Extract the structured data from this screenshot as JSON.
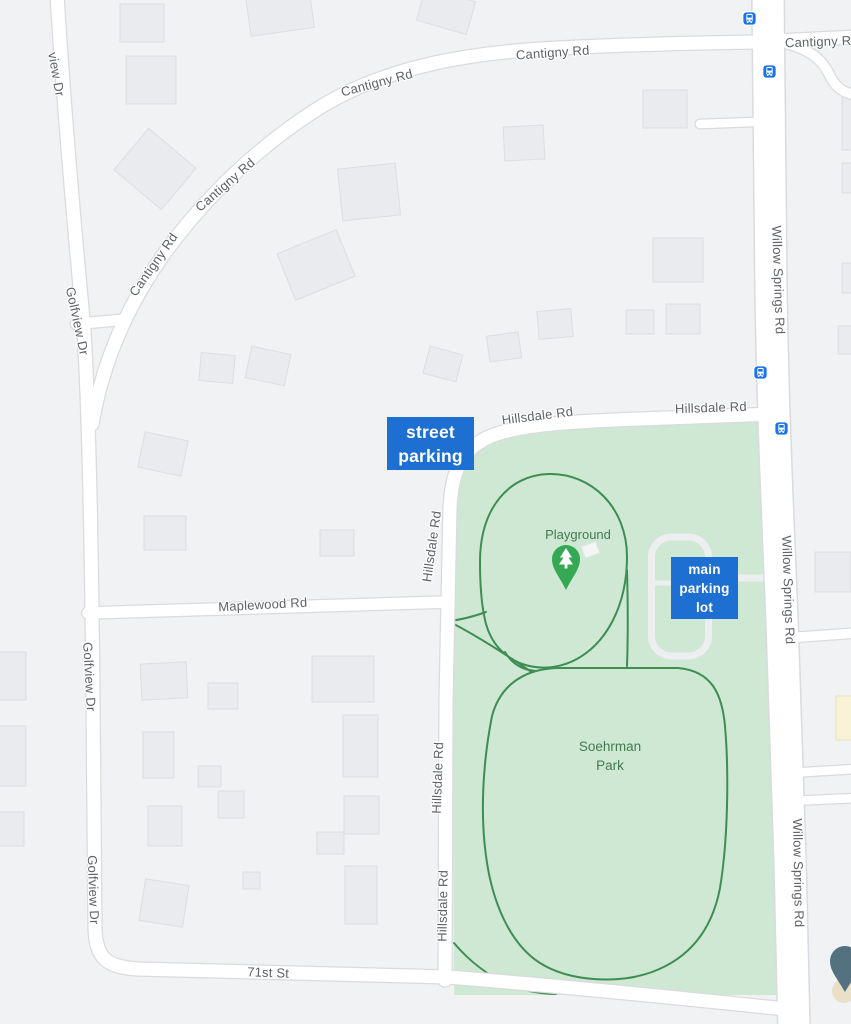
{
  "park": {
    "name": "Soehrman\nPark",
    "playground_label": "Playground",
    "fill_color": "#cee8d3",
    "path_color": "#3e8e53",
    "label_color": "#447b51"
  },
  "roads": {
    "label_color": "#5e6167",
    "cantigny_rd": "Cantigny Rd",
    "golfview_dr": "Golfview Dr",
    "golfview_dr_partial": "view Dr",
    "hillsdale_rd": "Hillsdale Rd",
    "maplewood_rd": "Maplewood Rd",
    "seventy_first_st": "71st St",
    "willow_springs_rd": "Willow Springs Rd"
  },
  "annotations": {
    "street_parking": {
      "label": "street\nparking",
      "bg_color": "#1d6fd1",
      "text_color": "#ffffff"
    },
    "main_parking_lot": {
      "label": "main\nparking\nlot",
      "bg_color": "#1d6fd1",
      "text_color": "#ffffff"
    }
  },
  "transit": {
    "bus_stop_count": 4,
    "bus_icon_color": "#1a73e8"
  },
  "markers": {
    "playground_pin_color": "#34a853",
    "place_pin_color": "#54717f",
    "place_pin_inner_color": "#eae0c8"
  },
  "canvas": {
    "background_color": "#f1f2f4",
    "building_color": "#e9ebee",
    "commercial_building_color": "#f8f3d6",
    "road_fill": "#ffffff",
    "road_casing": "#d9dbde"
  }
}
